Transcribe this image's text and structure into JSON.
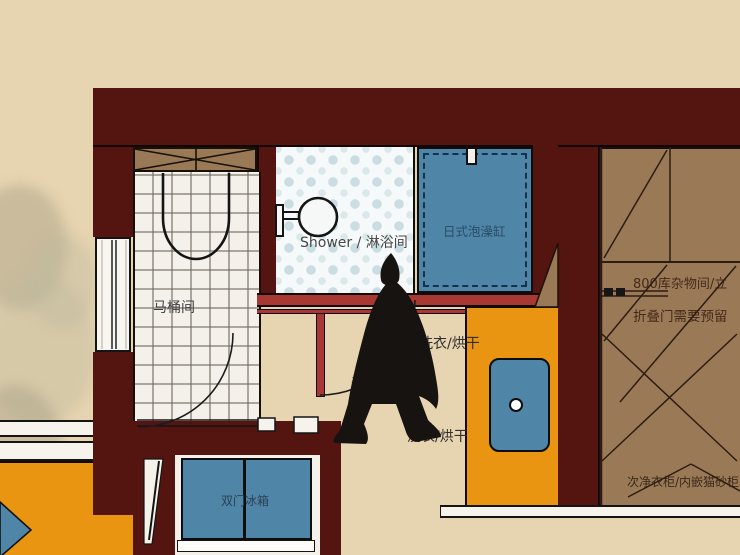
{
  "floorplan": {
    "shower": {
      "label": "Shower / 淋浴间"
    },
    "tub": {
      "label": "日式泡澡缸"
    },
    "toilet": {
      "label": "马桶间"
    },
    "laundry": {
      "label_upper": "洗衣/烘干",
      "label_lower": "洗衣/烘干",
      "sink_label": "干区洗手台"
    },
    "fridge": {
      "label": "双门冰箱"
    },
    "storage": {
      "line1": "800库杂物间/立",
      "line2": "折叠门需要预留"
    },
    "closet": {
      "label": "次净衣柜/内嵌猫砂柜"
    }
  },
  "colors": {
    "wall_maroon": "#541410",
    "accent_red": "#a83832",
    "cabinet_tan": "#9a7a56",
    "fixture_blue": "#4f85a6",
    "counter_orange": "#e99511",
    "background_beige": "#e7d4b0",
    "tile_white": "#f3f1ea"
  }
}
